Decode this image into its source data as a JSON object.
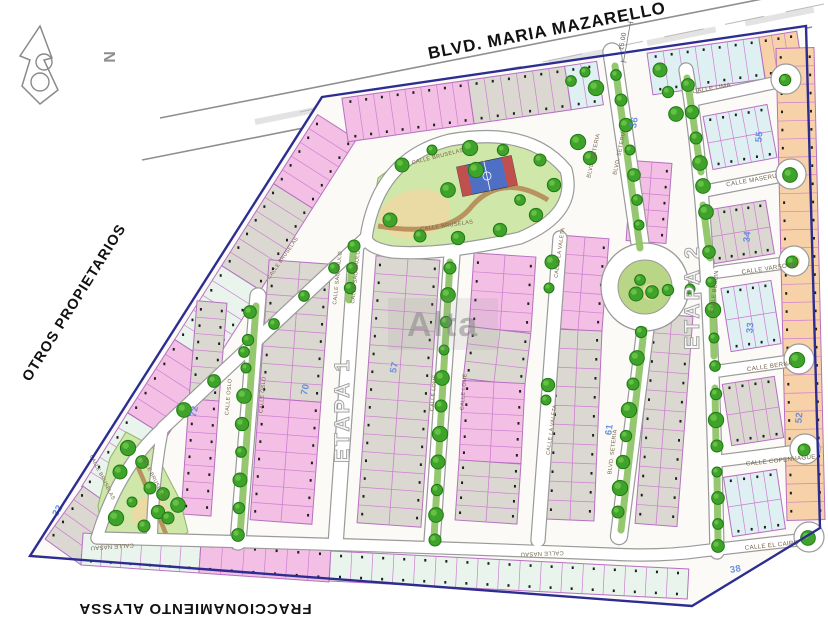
{
  "labels": {
    "boulevard": "BLVD. MARIA MAZARELLO",
    "west_neighbor": "OTROS PROPIETARIOS",
    "south_neighbor": "FRACCIONAMIENTO ALYSSA",
    "road_dimension": "15.00",
    "watermark": "Alta",
    "compass_letter": "N"
  },
  "phases": {
    "phase1": "ETAPA 1",
    "phase2": "ETAPA 2"
  },
  "streets": {
    "bruselas": "CALLE BRUSELAS",
    "sao_paulo": "CALLE SAO PAULO",
    "oslo": "CALLE OSLO",
    "lome": "CALLE LOME",
    "la_valeta": "CALLE LA VALETA",
    "seteria": "BLVD. SETERIA",
    "lima": "CALLE LIMA",
    "maseru": "CALLE MASERU",
    "varsovia": "CALLE VARSOVIA",
    "berlin": "CALLE BERLIN",
    "berna": "CALLE BERNA",
    "copenhague": "CALLE COPENHAGUE",
    "el_cairo": "CALLE EL CAIRO",
    "nasau": "CALLE NASAU"
  },
  "block_numbers": [
    "36",
    "55",
    "34",
    "33",
    "52",
    "57",
    "70",
    "72",
    "61",
    "38",
    "32"
  ],
  "colors": {
    "gray": "#dbd8d1",
    "pink": "#f3bfe5",
    "mint": "#e9f4ec",
    "cyan": "#dff0f3",
    "salmon": "#f7d2a8",
    "park_green": "#cfe7a8",
    "median_green": "#8fc468",
    "sand": "#ecd9a4",
    "tree_fill": "#3fa32b",
    "tree_edge": "#1f7a12",
    "tree_light": "#6cc54a",
    "lot_line": "#cf7ed2",
    "block_edge": "#b76fc1",
    "road_white": "#ffffff",
    "casing_gray": "#9a9a9a",
    "boundary_navy": "#2d2d91",
    "label_brown": "#75634a",
    "block_number_blue": "#5b86de",
    "ink_black": "#111111",
    "court_blue": "#4f6fc4",
    "court_red": "#c0504d",
    "path_brown": "#b58a56"
  }
}
